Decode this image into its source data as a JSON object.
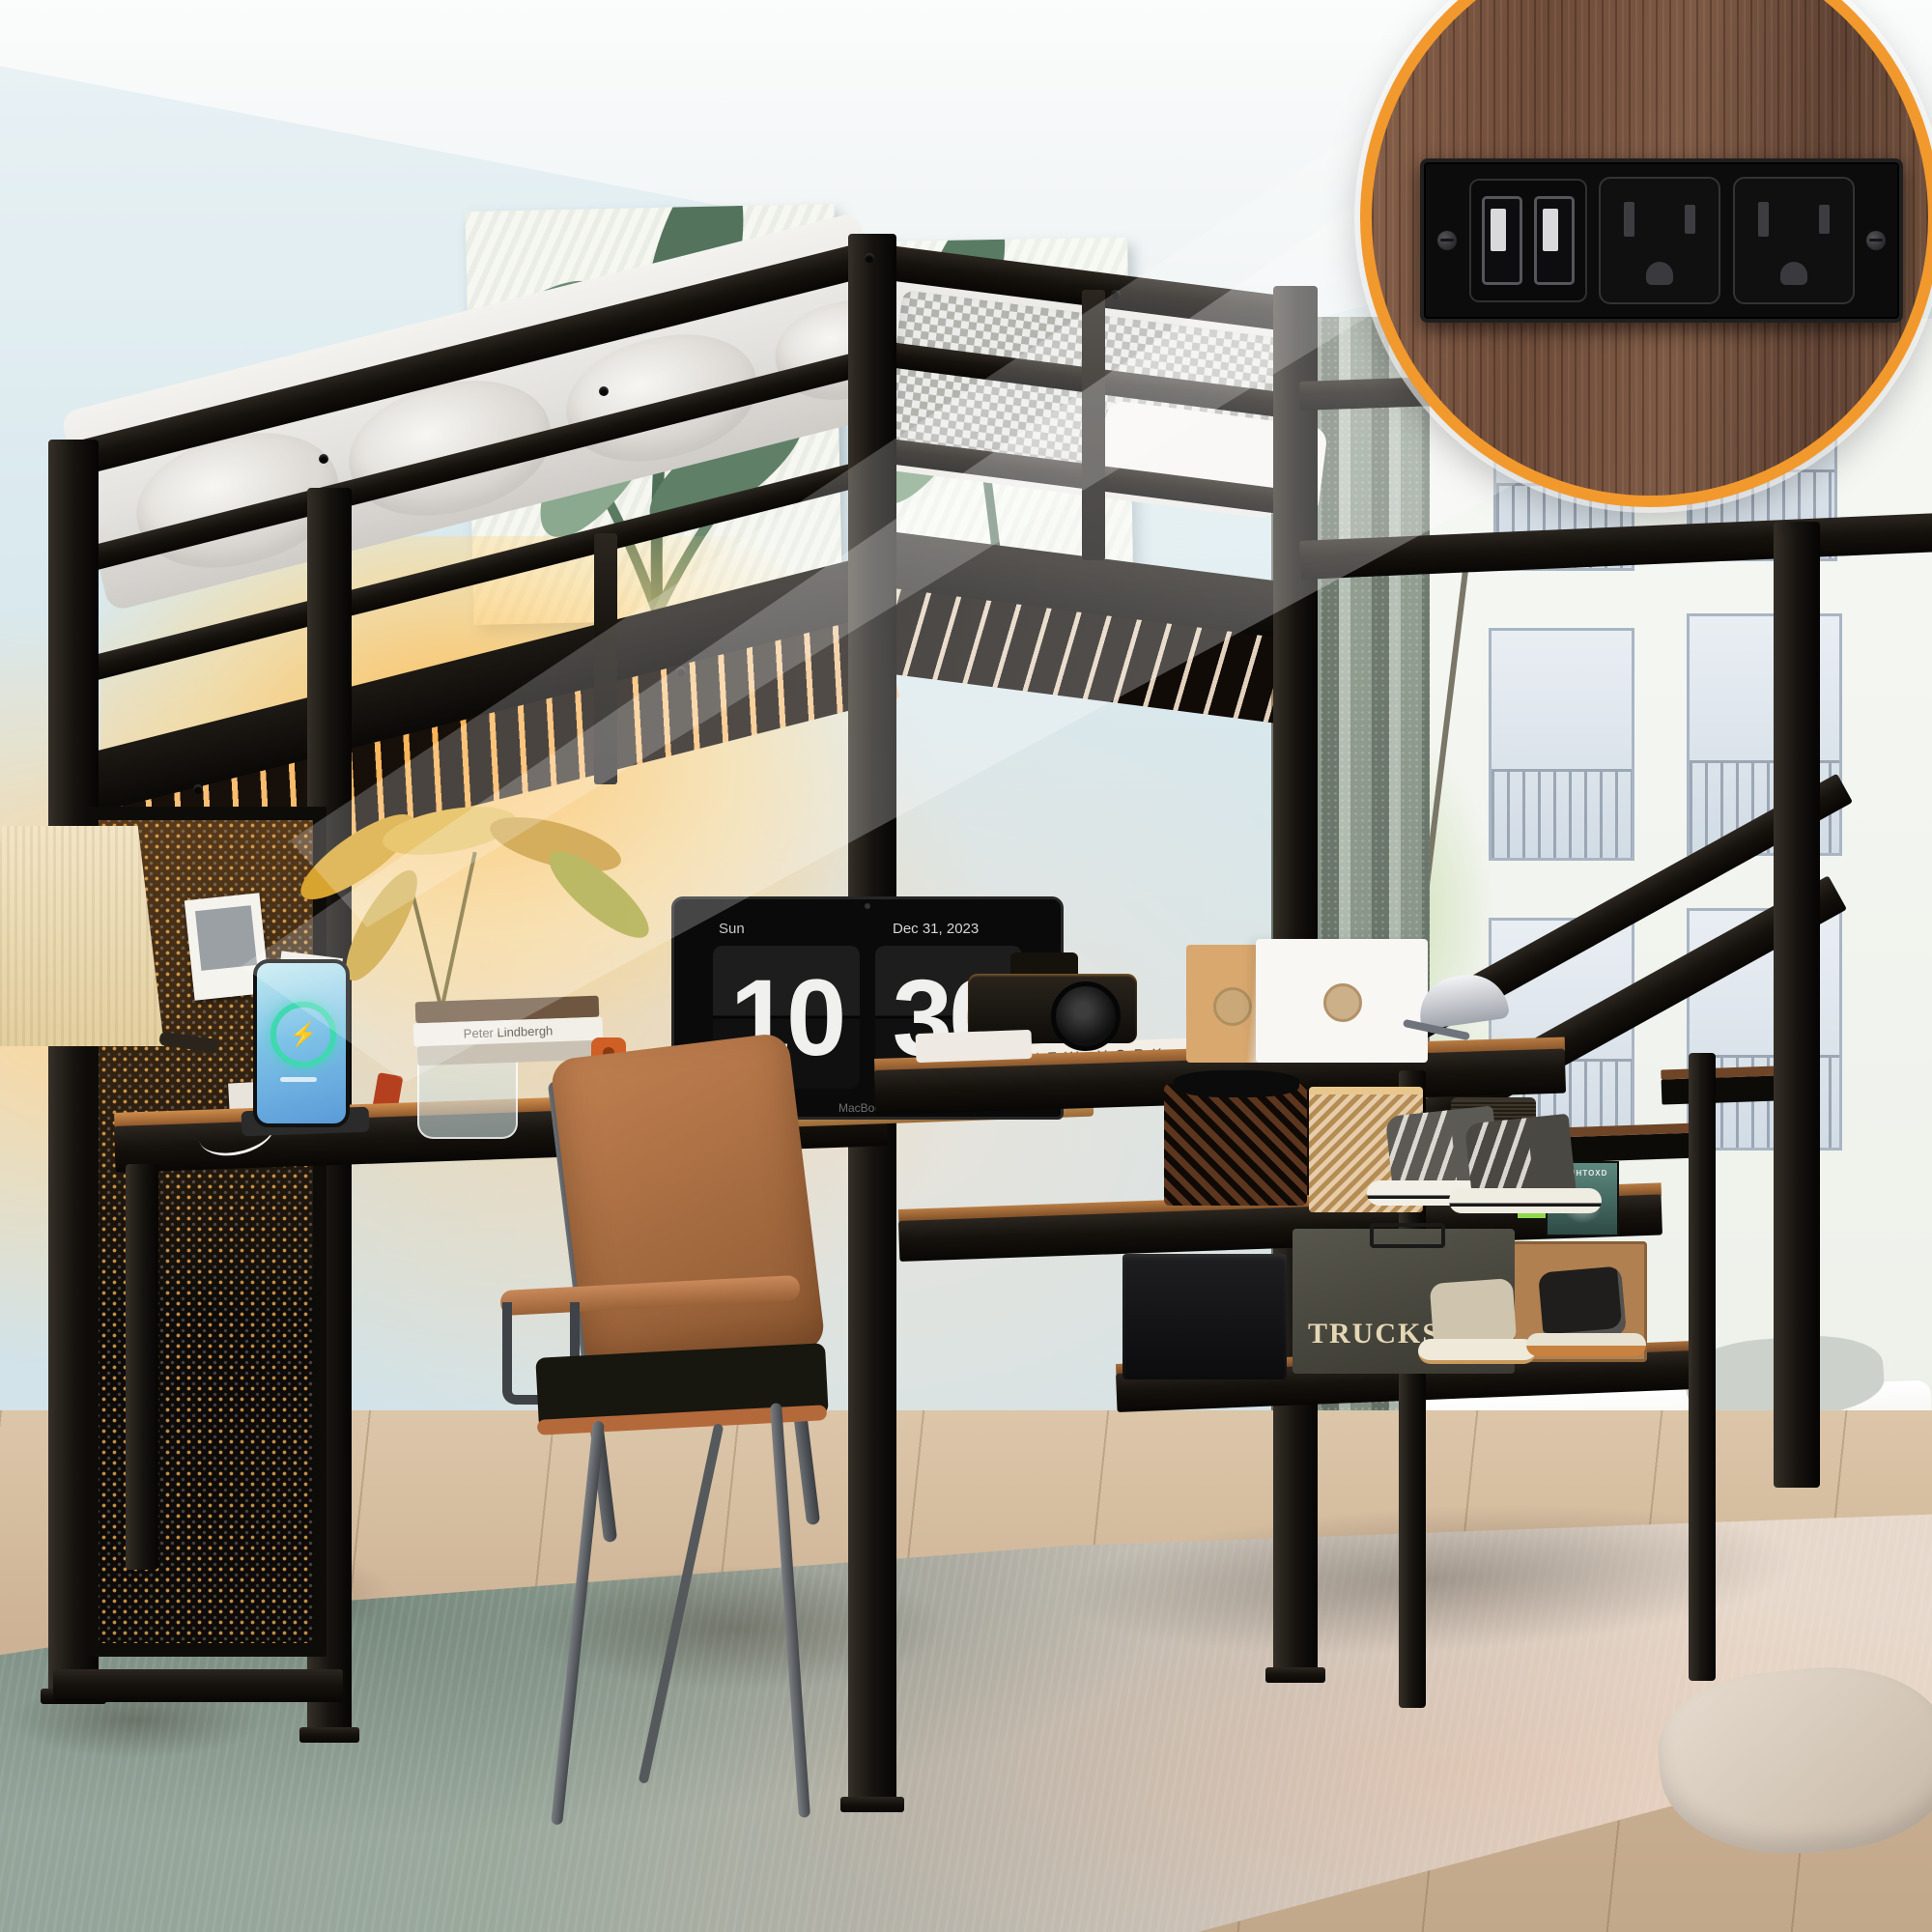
{
  "colors": {
    "accent": "#F2992E",
    "glow": "#FFC66B",
    "wall": "#D8E8EE",
    "curtain": "#A3B0A3",
    "frame": "#15120E",
    "wood": "#8A5328",
    "rug_green": "#93A399",
    "screen_blue": "#7FC3E8",
    "ring_teal": "#3FD8B0",
    "stencil": "#E4D7B4"
  },
  "icons": {
    "bolt": "⚡"
  },
  "clock": {
    "day": "Sun",
    "date": "Dec 31, 2023",
    "hour": "10",
    "minute": "30",
    "meridiem": "AM"
  },
  "laptop": {
    "brand": "MacBook"
  },
  "desk_books": {
    "spine_title": "Peter Lindbergh",
    "top_title": "NEW YORK"
  },
  "shelf": {
    "speaker_brand": "Marshall",
    "album_title": "AIDNHTOXD",
    "poster_text": "ナオ"
  },
  "storage": {
    "trucks_label": "TRUCKS"
  }
}
